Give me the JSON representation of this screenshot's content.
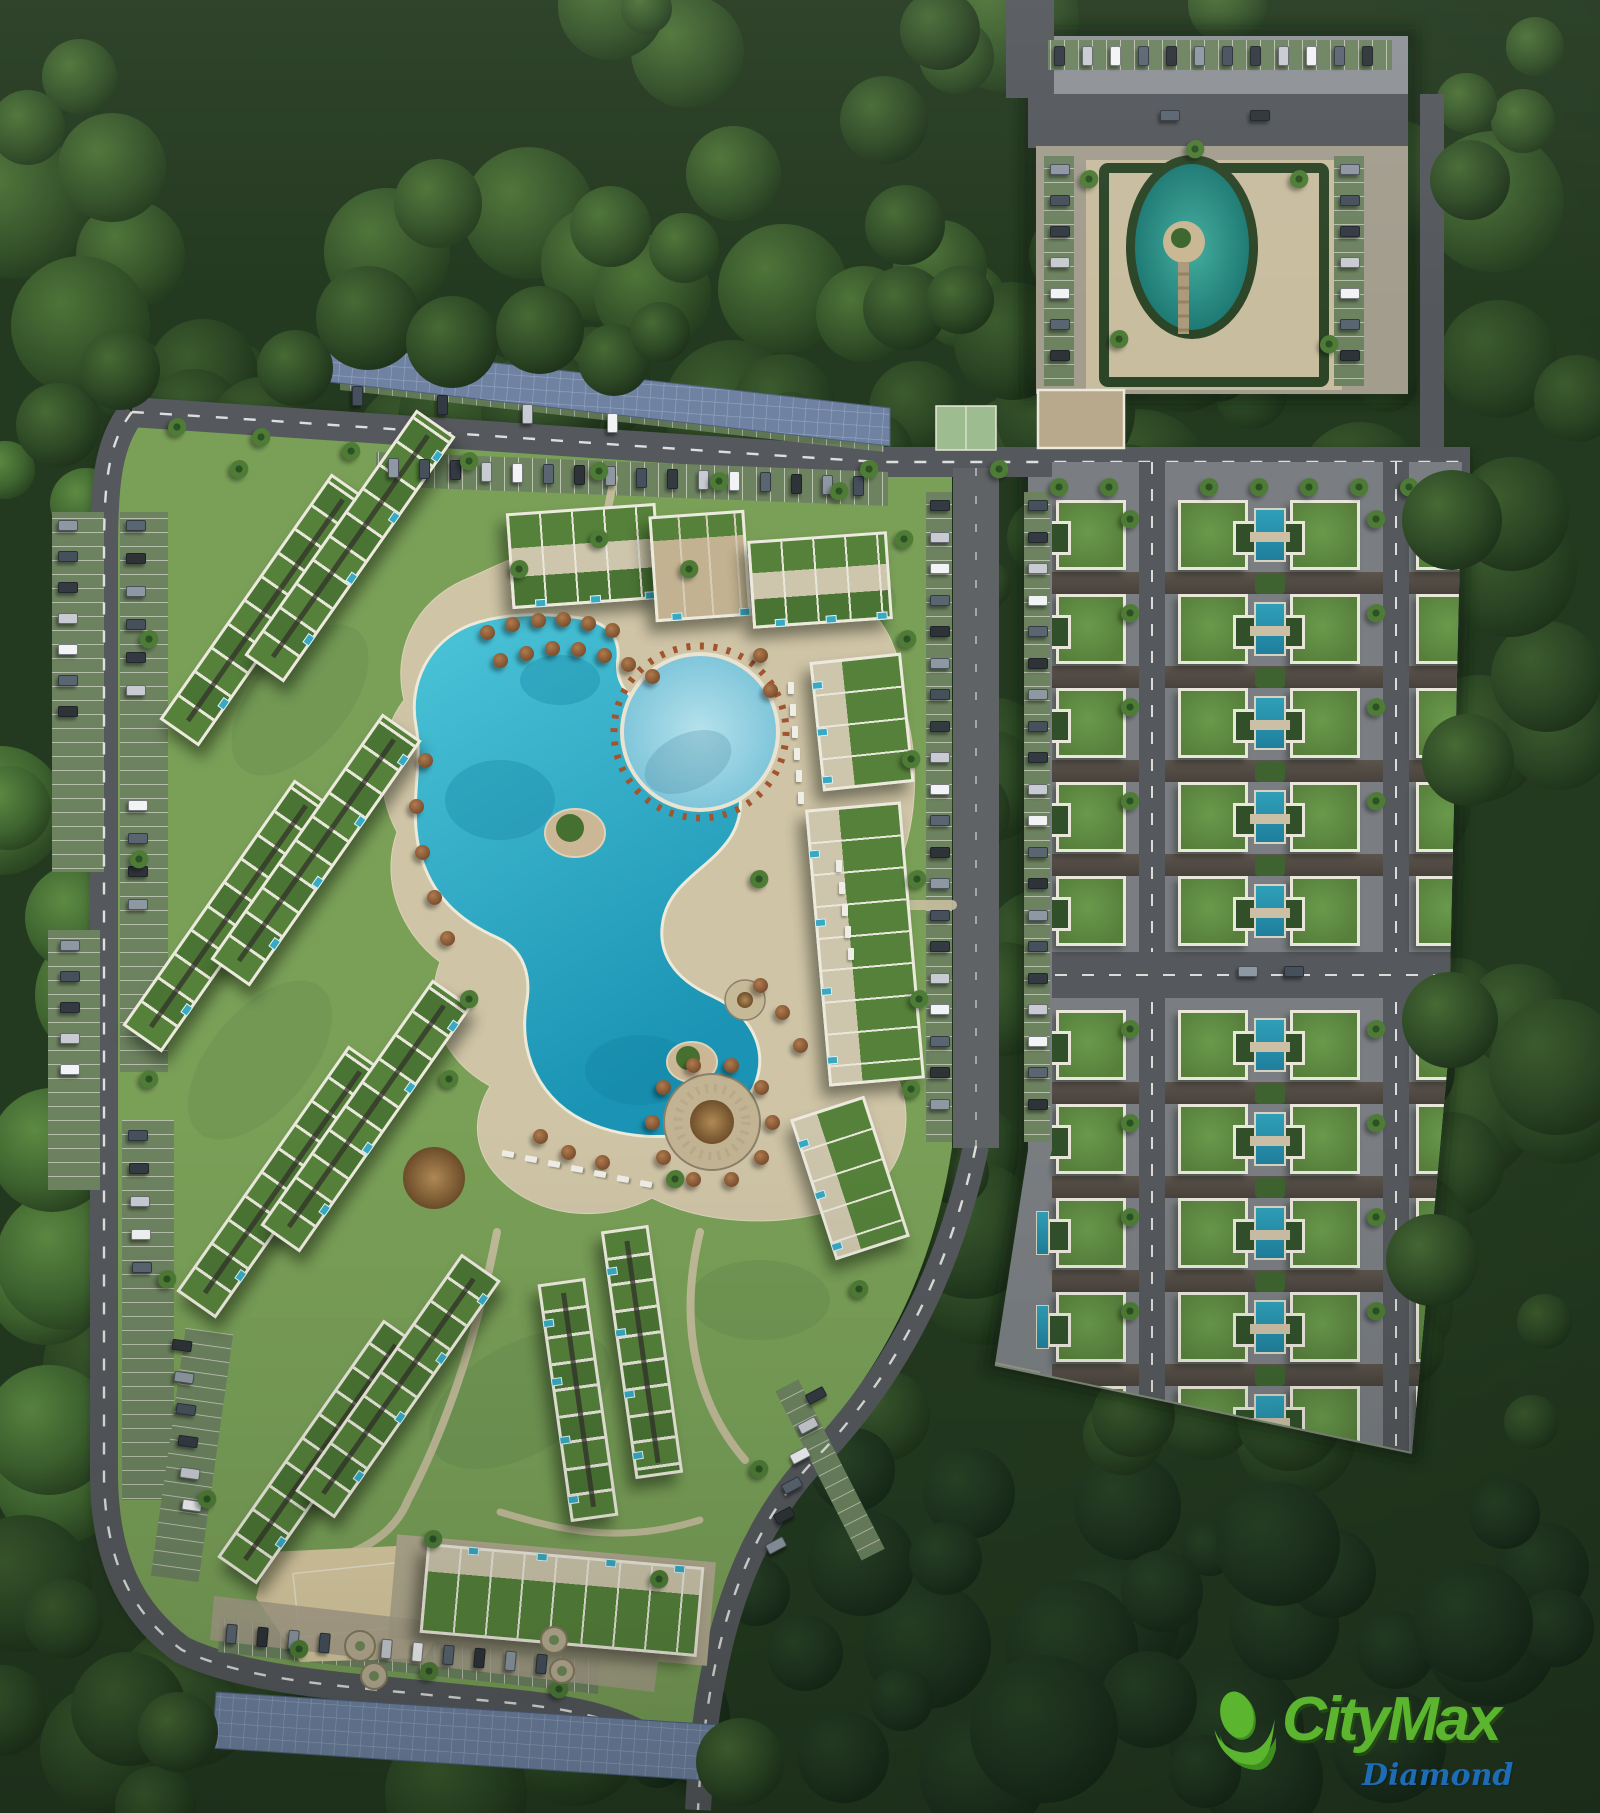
{
  "logo": {
    "brand": "CityMax",
    "sub": "Diamond",
    "brand_color": "#5cb52f",
    "brand_shade": "#3e8f1d",
    "sub_color": "#1e6cb5"
  },
  "scene": {
    "type": "aerial-master-plan-render",
    "description": "Top-down 3D rendering of a tropical resort-style residential development surrounded by dense jungle forest",
    "features": [
      "jungle-forest",
      "loop-road",
      "lagoon-pool",
      "round-kids-pool",
      "pool-islands",
      "pool-deck",
      "palapa-umbrellas",
      "apartment-buildings-with-green-roofs",
      "private-plunge-pools",
      "villa-grid-with-lap-pools",
      "central-parking-aisle",
      "solar-canopy-parking",
      "entry-parking-plaza",
      "oval-pond-with-island",
      "hedge-garden",
      "sand-beach-area",
      "beach-volleyball-court",
      "sports-court",
      "roundabout-planters",
      "palm-trees",
      "parked-cars",
      "exit-road"
    ]
  },
  "palette": {
    "forest_dark": "#1e311c",
    "forest_mid": "#2a4424",
    "forest_light": "#4e7a38",
    "grass": "#7aa058",
    "asphalt": "#55585c",
    "dash": "#e9eae8",
    "pavement": "#8e9297",
    "paver_tan": "#a39d8e",
    "sand": "#cfc4a6",
    "sand_bright": "#dacba2",
    "solar": "#6f82a2",
    "stall_green": "#6d8360",
    "pool_turquoise": "#2ba8c4",
    "pool_light": "#8fd0e0",
    "villa_pool": "#2795ab",
    "pond_teal": "#2f978c",
    "hedge": "#2c4527",
    "roof_green": "#55813a",
    "trim_white": "#ece9dd",
    "beige": "#cdc5ac",
    "umbrella_brown": "#8a5a38",
    "car_colors": [
      "#343a42",
      "#c8ccd2",
      "#f2f3f4",
      "#5a6572",
      "#2e3338",
      "#8e98a2",
      "#46505c"
    ]
  },
  "site": {
    "forest": {
      "count": 300,
      "seed": 11
    },
    "canopy": [
      {
        "x": 368,
        "y": 318,
        "r": 52
      },
      {
        "x": 452,
        "y": 342,
        "r": 46
      },
      {
        "x": 540,
        "y": 330,
        "r": 44
      },
      {
        "x": 614,
        "y": 360,
        "r": 36
      },
      {
        "x": 295,
        "y": 368,
        "r": 38
      },
      {
        "x": 660,
        "y": 332,
        "r": 30
      },
      {
        "x": 905,
        "y": 308,
        "r": 42
      },
      {
        "x": 120,
        "y": 370,
        "r": 40
      },
      {
        "x": 58,
        "y": 425,
        "r": 42
      },
      {
        "x": 1452,
        "y": 520,
        "r": 50
      },
      {
        "x": 1468,
        "y": 760,
        "r": 46
      },
      {
        "x": 1450,
        "y": 1020,
        "r": 48
      },
      {
        "x": 1432,
        "y": 1260,
        "r": 46
      },
      {
        "x": 740,
        "y": 1762,
        "r": 44
      },
      {
        "x": 178,
        "y": 1732,
        "r": 40
      },
      {
        "x": 940,
        "y": 30,
        "r": 40
      },
      {
        "x": 884,
        "y": 120,
        "r": 44
      },
      {
        "x": 905,
        "y": 225,
        "r": 40
      },
      {
        "x": 960,
        "y": 300,
        "r": 34
      },
      {
        "x": 1470,
        "y": 180,
        "r": 40
      }
    ],
    "buildings": [
      {
        "cx": 265,
        "cy": 610,
        "w": 300,
        "h": 48,
        "rot": -55,
        "t": "slab",
        "ps": "s"
      },
      {
        "cx": 350,
        "cy": 546,
        "w": 300,
        "h": 48,
        "rot": -55,
        "t": "slab",
        "ps": "s"
      },
      {
        "cx": 228,
        "cy": 916,
        "w": 300,
        "h": 48,
        "rot": -55,
        "t": "slab",
        "ps": "s"
      },
      {
        "cx": 316,
        "cy": 850,
        "w": 300,
        "h": 48,
        "rot": -55,
        "t": "slab",
        "ps": "s"
      },
      {
        "cx": 282,
        "cy": 1182,
        "w": 300,
        "h": 48,
        "rot": -55,
        "t": "slab",
        "ps": "s"
      },
      {
        "cx": 366,
        "cy": 1116,
        "w": 300,
        "h": 48,
        "rot": -55,
        "t": "slab",
        "ps": "s"
      },
      {
        "cx": 320,
        "cy": 1452,
        "w": 290,
        "h": 48,
        "rot": -55,
        "t": "slab",
        "ps": "s"
      },
      {
        "cx": 398,
        "cy": 1386,
        "w": 290,
        "h": 48,
        "rot": -55,
        "t": "slab",
        "ps": "s"
      },
      {
        "cx": 584,
        "cy": 556,
        "w": 150,
        "h": 96,
        "rot": -4,
        "t": "block",
        "ps": "s"
      },
      {
        "cx": 700,
        "cy": 566,
        "w": 96,
        "h": 106,
        "rot": -4,
        "t": "blocktan",
        "ps": "s"
      },
      {
        "cx": 820,
        "cy": 580,
        "w": 140,
        "h": 88,
        "rot": -4,
        "t": "block",
        "ps": "s"
      },
      {
        "cx": 862,
        "cy": 722,
        "w": 92,
        "h": 130,
        "rot": -6,
        "t": "blockv",
        "ps": "w"
      },
      {
        "cx": 865,
        "cy": 944,
        "w": 96,
        "h": 278,
        "rot": -5,
        "t": "blockv",
        "ps": "w"
      },
      {
        "cx": 850,
        "cy": 1178,
        "w": 78,
        "h": 148,
        "rot": -18,
        "t": "blockv",
        "ps": "w"
      },
      {
        "cx": 578,
        "cy": 1400,
        "w": 48,
        "h": 240,
        "rot": -8,
        "t": "slabv",
        "ps": "w"
      },
      {
        "cx": 642,
        "cy": 1352,
        "w": 48,
        "h": 250,
        "rot": -8,
        "t": "slabv",
        "ps": "w"
      },
      {
        "cx": 562,
        "cy": 1600,
        "w": 278,
        "h": 90,
        "rot": 5,
        "t": "blockn",
        "ps": "n"
      }
    ],
    "villa_grid": {
      "size": 70,
      "cols": [
        {
          "x": 1056,
          "face": "w",
          "sliver": true
        },
        {
          "x": 1178,
          "face": "e"
        },
        {
          "x": 1290,
          "face": "w"
        },
        {
          "x": 1416,
          "face": "e"
        }
      ],
      "upper_rows": [
        500,
        594,
        688,
        782,
        876
      ],
      "lower_rows": [
        1010,
        1104,
        1198,
        1292,
        1386
      ],
      "pool_x": 1254,
      "sliver_x": 1036,
      "band_spans": [
        [
          1052,
          87
        ],
        [
          1165,
          218
        ],
        [
          1409,
          53
        ]
      ],
      "roads": {
        "b_x": 1139,
        "c_x": 1383,
        "h_y": 952
      }
    },
    "car_strips": [
      {
        "x": 1054,
        "y": 46,
        "n": 12,
        "dx": 28,
        "dy": 0,
        "dir": "v"
      },
      {
        "x": 1050,
        "y": 164,
        "n": 7,
        "dx": 0,
        "dy": 31,
        "dir": "h"
      },
      {
        "x": 1340,
        "y": 164,
        "n": 7,
        "dx": 0,
        "dy": 31,
        "dir": "h"
      },
      {
        "x": 388,
        "y": 458,
        "n": 16,
        "dx": 31,
        "dy": 1.2,
        "dir": "v"
      },
      {
        "x": 930,
        "y": 500,
        "n": 20,
        "dx": 0,
        "dy": 31.5,
        "dir": "h"
      },
      {
        "x": 1028,
        "y": 500,
        "n": 20,
        "dx": 0,
        "dy": 31.5,
        "dir": "h"
      },
      {
        "x": 58,
        "y": 520,
        "n": 7,
        "dx": 0,
        "dy": 31,
        "dir": "h"
      },
      {
        "x": 60,
        "y": 940,
        "n": 5,
        "dx": 0,
        "dy": 31,
        "dir": "h"
      },
      {
        "x": 126,
        "y": 520,
        "n": 6,
        "dx": 0,
        "dy": 33,
        "dir": "h"
      },
      {
        "x": 128,
        "y": 800,
        "n": 4,
        "dx": 0,
        "dy": 33,
        "dir": "h"
      },
      {
        "x": 128,
        "y": 1130,
        "n": 5,
        "dx": 1,
        "dy": 33,
        "dir": "h"
      },
      {
        "x": 172,
        "y": 1340,
        "n": 6,
        "dx": 2,
        "dy": 32,
        "dir": "h",
        "rot": 8
      },
      {
        "x": 226,
        "y": 1624,
        "n": 11,
        "dx": 31,
        "dy": 3,
        "dir": "v",
        "rot": 5
      },
      {
        "x": 806,
        "y": 1390,
        "n": 6,
        "dx": -8,
        "dy": 30,
        "dir": "h",
        "rot": -28
      },
      {
        "x": 352,
        "y": 386,
        "n": 4,
        "dx": 85,
        "dy": 9,
        "dir": "v"
      },
      {
        "x": 1160,
        "y": 110,
        "n": 2,
        "dx": 90,
        "dy": 0,
        "dir": "h"
      },
      {
        "x": 1238,
        "y": 966,
        "n": 2,
        "dx": 46,
        "dy": 0,
        "dir": "h"
      }
    ],
    "umbrellas": [
      [
        487,
        632
      ],
      [
        512,
        624
      ],
      [
        538,
        620
      ],
      [
        563,
        619
      ],
      [
        588,
        623
      ],
      [
        612,
        630
      ],
      [
        500,
        660
      ],
      [
        526,
        653
      ],
      [
        552,
        648
      ],
      [
        578,
        649
      ],
      [
        604,
        655
      ],
      [
        628,
        664
      ],
      [
        652,
        676
      ],
      [
        425,
        760
      ],
      [
        416,
        806
      ],
      [
        422,
        852
      ],
      [
        434,
        897
      ],
      [
        447,
        938
      ],
      [
        760,
        985
      ],
      [
        782,
        1012
      ],
      [
        800,
        1045
      ],
      [
        540,
        1136
      ],
      [
        568,
        1152
      ],
      [
        602,
        1162
      ],
      [
        760,
        655
      ],
      [
        770,
        690
      ]
    ],
    "bar": {
      "x": 712,
      "y": 1122,
      "ring_r": 60,
      "ring_n": 10
    },
    "lounger_strips": [
      {
        "x": 788,
        "y": 682,
        "n": 6,
        "dx": 2,
        "dy": 22,
        "rot": 0
      },
      {
        "x": 505,
        "y": 1148,
        "n": 7,
        "dx": 23,
        "dy": 5,
        "rot": -80
      },
      {
        "x": 836,
        "y": 860,
        "n": 5,
        "dx": 3,
        "dy": 22,
        "rot": 0
      }
    ],
    "palms": [
      [
        178,
        428
      ],
      [
        262,
        438
      ],
      [
        352,
        452
      ],
      [
        470,
        462
      ],
      [
        600,
        472
      ],
      [
        720,
        482
      ],
      [
        840,
        492
      ],
      [
        905,
        540
      ],
      [
        908,
        640
      ],
      [
        912,
        760
      ],
      [
        918,
        880
      ],
      [
        920,
        1000
      ],
      [
        912,
        1090
      ],
      [
        240,
        470
      ],
      [
        150,
        640
      ],
      [
        140,
        860
      ],
      [
        150,
        1080
      ],
      [
        168,
        1280
      ],
      [
        208,
        1500
      ],
      [
        300,
        1650
      ],
      [
        430,
        1672
      ],
      [
        560,
        1690
      ],
      [
        660,
        1580
      ],
      [
        760,
        1470
      ],
      [
        860,
        1290
      ],
      [
        1090,
        180
      ],
      [
        1300,
        180
      ],
      [
        1120,
        340
      ],
      [
        1330,
        345
      ],
      [
        1196,
        150
      ],
      [
        434,
        1540
      ],
      [
        676,
        1180
      ],
      [
        600,
        540
      ],
      [
        520,
        570
      ],
      [
        470,
        1000
      ],
      [
        450,
        1080
      ],
      [
        760,
        880
      ],
      [
        690,
        570
      ],
      [
        1000,
        470
      ],
      [
        870,
        470
      ]
    ],
    "villa_palm_rows": [
      520,
      614,
      708,
      802,
      1030,
      1124,
      1218,
      1312
    ],
    "villa_palm_xs": [
      1131,
      1377
    ],
    "villa_palm_top": [
      1060,
      1110,
      1210,
      1260,
      1310,
      1360,
      1410
    ],
    "roundabouts": [
      {
        "x": 360,
        "y": 1646,
        "r": 16
      },
      {
        "x": 374,
        "y": 1676,
        "r": 14
      },
      {
        "x": 554,
        "y": 1640,
        "r": 14
      },
      {
        "x": 562,
        "y": 1671,
        "r": 13
      }
    ]
  }
}
